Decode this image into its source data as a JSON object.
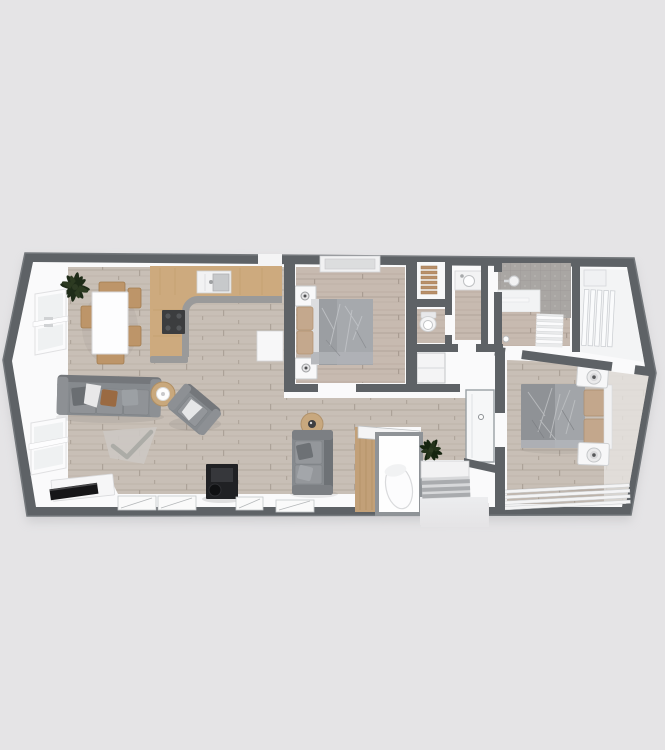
{
  "scene": {
    "description": "3D top-down dollhouse render of a two-bedroom lodge floor plan centered on a plain light gray background",
    "background": "#e5e4e6"
  },
  "palette": {
    "outer_wall": "#5e6266",
    "outer_wall_light": "#75797d",
    "interior_white": "#fafafb",
    "floor_wood": "#c8bfb6",
    "floor_wood_bedroom": "#c7bab0",
    "plank_line": "#b5aba1",
    "kitchen_counter_wood": "#cdaa7e",
    "counter_edge_gray": "#9a9a9a",
    "tile_gray": "#a9a6a3",
    "sofa_gray": "#868a8e",
    "sofa_gray_dark": "#6e7276",
    "duvet_gray": "#9b9ea2",
    "pillow_tan": "#c3a78c",
    "chair_wood_tan": "#bd9569",
    "plant_green": "#1e2b18",
    "tv_black": "#161618",
    "stove_black": "#202124",
    "fixture_white": "#f5f6f7",
    "steps_gray": "#a9abae"
  },
  "floorplan": {
    "label": "Two bedroom lodge floor plan, 3D top view, no text labels",
    "shape": "long rectangle with chamfered pointed left end and chamfered right end, entrance steps recess at bottom center-right",
    "rooms": [
      {
        "name": "open-plan living / kitchen / dining",
        "furniture": [
          "three-seat gray sofa with throw pillows",
          "gray armchair",
          "round wood coffee table",
          "gray rug",
          "white TV unit with flat TV",
          "black log-burner stove",
          "white dining table",
          "five tan dining chairs",
          "potted plant",
          "L-shaped wood kitchen counter with gray edge",
          "dark cooktop",
          "sink unit",
          "white end panel",
          "sliding glass doors along bottom wall",
          "two angled windows on left end"
        ]
      },
      {
        "name": "bedroom 2",
        "furniture": [
          "double bed with gray duvet and tan pillows",
          "two white nightstands",
          "window in top wall"
        ]
      },
      {
        "name": "wardrobe closet",
        "furniture": [
          "wood slat shelving"
        ]
      },
      {
        "name": "wc",
        "furniture": [
          "toilet"
        ]
      },
      {
        "name": "vanity room",
        "furniture": [
          "wash basin vanity"
        ]
      },
      {
        "name": "en-suite shower room",
        "furniture": [
          "gray tiled walls",
          "shower head",
          "white wainscot shelf",
          "towel radiator"
        ]
      },
      {
        "name": "dressing room",
        "furniture": [
          "white wardrobe panels",
          "white floor"
        ]
      },
      {
        "name": "master bedroom",
        "furniture": [
          "double bed with gray duvet and tan pillows",
          "two white nightstands with round lamps",
          "white slatted bench"
        ]
      },
      {
        "name": "hallway",
        "furniture": [
          "gray loveseat",
          "round side table",
          "wood airing cupboard with white boiler cylinder",
          "potted plant",
          "white entry cupboard"
        ]
      },
      {
        "name": "entrance",
        "furniture": [
          "white threshold landing",
          "gray striped steps"
        ]
      }
    ]
  }
}
